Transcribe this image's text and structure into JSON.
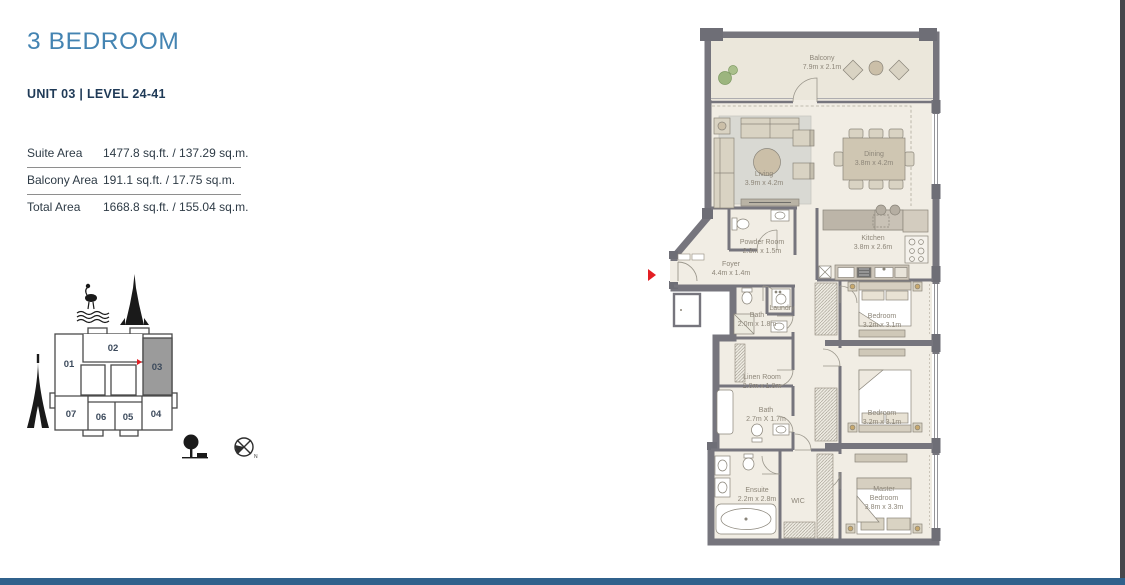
{
  "page": {
    "title": "3 BEDROOM",
    "unit_info": "UNIT 03 | LEVEL 24-41"
  },
  "area_table": {
    "rows": [
      {
        "label": "Suite Area",
        "value": "1477.8 sq.ft. / 137.29 sq.m."
      },
      {
        "label": "Balcony Area",
        "value": "191.1 sq.ft. / 17.75 sq.m."
      },
      {
        "label": "Total Area",
        "value": "1668.8 sq.ft. / 155.04 sq.m."
      }
    ]
  },
  "key_plan": {
    "units": [
      "01",
      "02",
      "03",
      "04",
      "05",
      "06",
      "07"
    ],
    "highlighted_unit": "03",
    "compass_north_label": "N"
  },
  "floor_plan": {
    "rooms": [
      {
        "name": "Balcony",
        "dims": "7.9m x 2.1m"
      },
      {
        "name": "Living",
        "dims": "3.9m x 4.2m"
      },
      {
        "name": "Dining",
        "dims": "3.8m x 4.2m"
      },
      {
        "name": "Powder Room",
        "dims": "2.3m x 1.5m"
      },
      {
        "name": "Foyer",
        "dims": "4.4m x 1.4m"
      },
      {
        "name": "Kitchen",
        "dims": "3.8m x 2.6m"
      },
      {
        "name": "Bath",
        "dims": "2.0m x 1.8m"
      },
      {
        "name": "Laundry",
        "dims": ""
      },
      {
        "name": "Bedroom",
        "dims": "3.2m x 3.1m"
      },
      {
        "name": "Linen Room",
        "dims": "2.0m x 1.8m"
      },
      {
        "name": "Bath",
        "dims": "2.7m X 1.7m"
      },
      {
        "name": "Bedroom",
        "dims": "3.2m x 3.1m"
      },
      {
        "name": "Ensuite",
        "dims": "2.2m x 2.8m"
      },
      {
        "name": "WIC",
        "dims": ""
      },
      {
        "name": "Master\nBedroom",
        "dims": "3.8m x 3.3m"
      }
    ]
  },
  "colors": {
    "accent_blue": "#4484b2",
    "navy": "#1f3a57",
    "footer_bar": "#30618c",
    "edge_bar": "#47474c",
    "highlight_red": "#e31e24",
    "plan_wall": "#76757d",
    "plan_floor": "#f1ede4",
    "key_plan_highlight": "#9b9b9b"
  }
}
